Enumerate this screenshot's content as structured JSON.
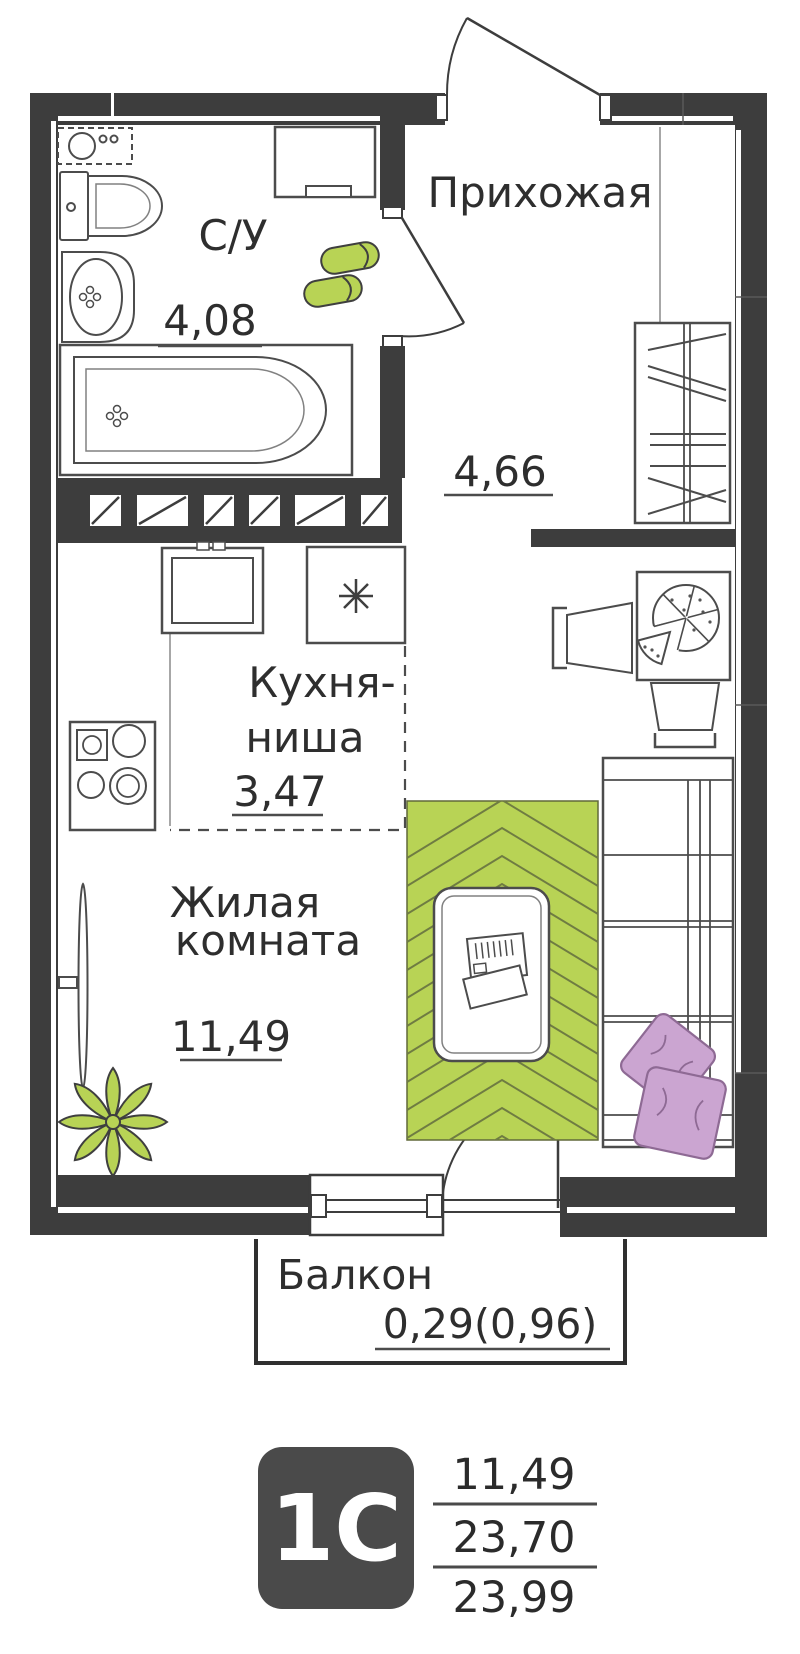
{
  "rooms": {
    "hallway": {
      "label": "Прихожая",
      "area": "4,66"
    },
    "bathroom": {
      "label": "С/У",
      "area": "4,08"
    },
    "kitchen": {
      "label_line1": "Кухня-",
      "label_line2": "ниша",
      "area": "3,47"
    },
    "living": {
      "label_line1": "Жилая",
      "label_line2": "комната",
      "area": "11,49"
    },
    "balcony": {
      "label": "Балкон",
      "area": "0,29(0,96)"
    }
  },
  "legend": {
    "badge": "1С",
    "living_area": "11,49",
    "area_no_balcony": "23,70",
    "total_area": "23,99"
  },
  "colors": {
    "wall": "#3d3d3d",
    "furniture_line": "#4c4c4c",
    "accent_green": "#b8d355",
    "rug_line": "#6f7c42",
    "pillow": "#cba5d1",
    "pillow_line": "#8e6a94",
    "badge_background": "#4a4a4a",
    "text": "#2e2e2e",
    "background": "#ffffff"
  }
}
